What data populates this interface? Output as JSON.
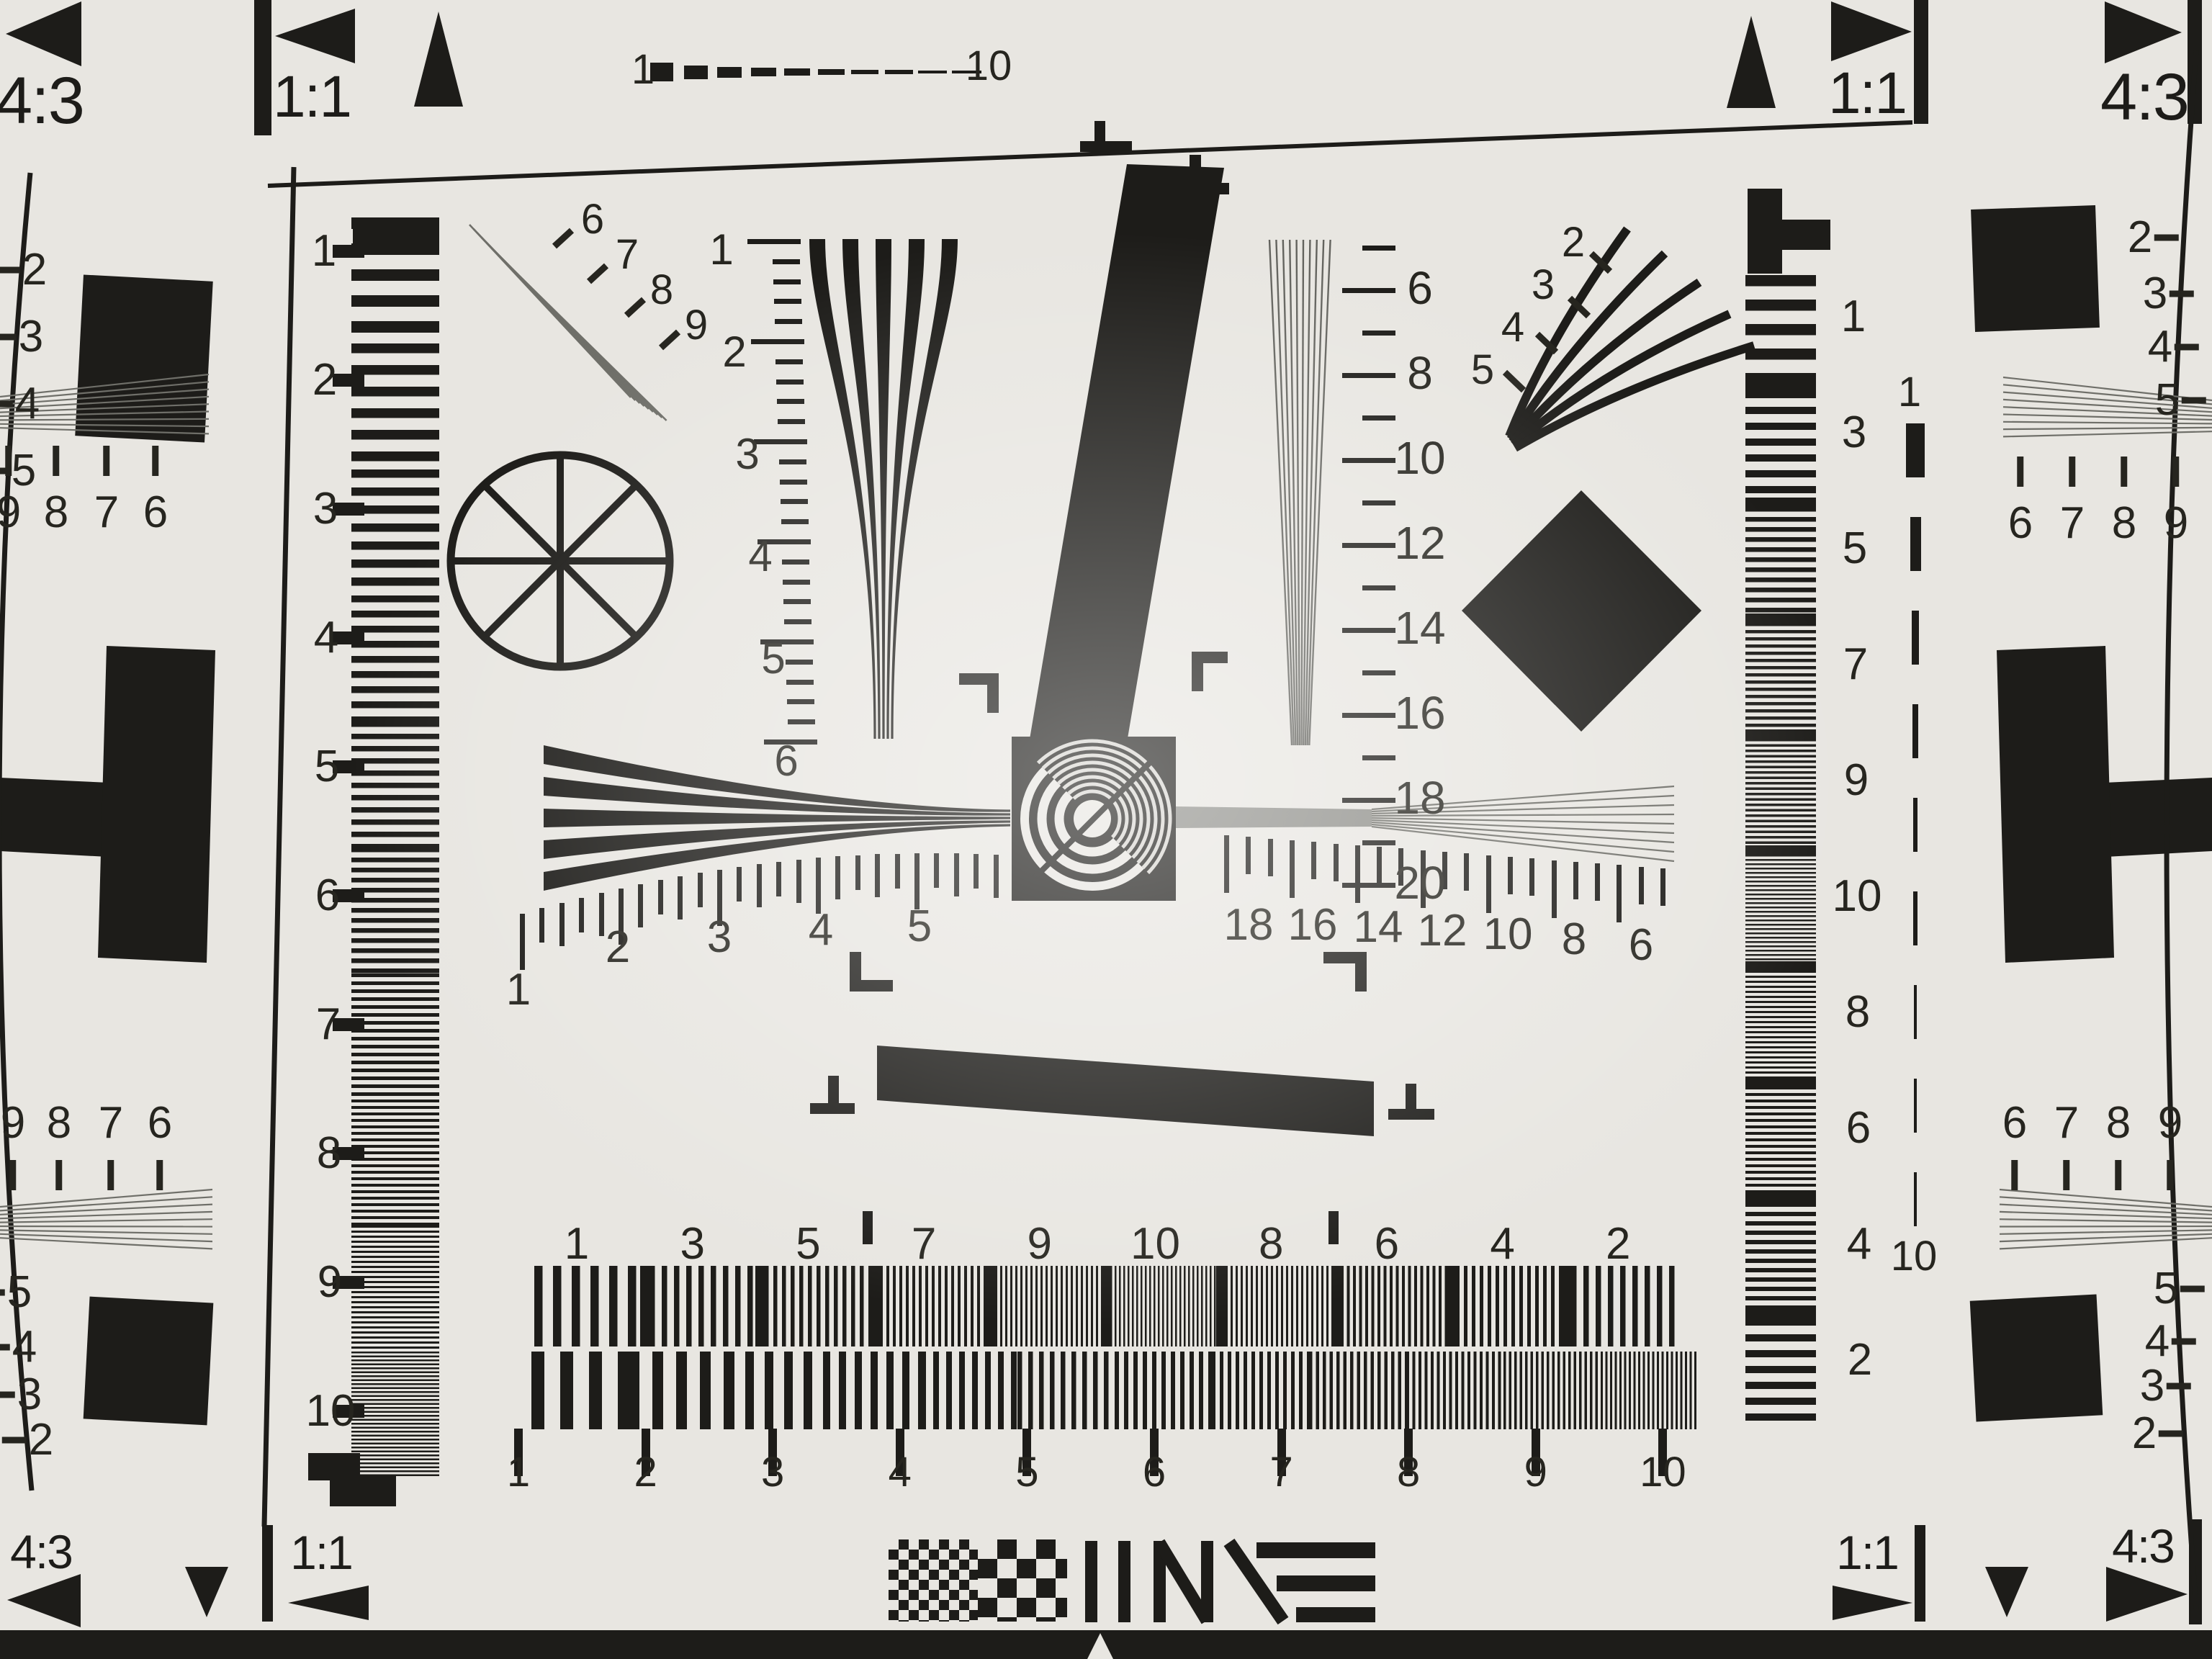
{
  "colors": {
    "background": "#e8e6e1",
    "ink": "#1d1c19",
    "gray_lines": "#6f6f69"
  },
  "corners": {
    "top_left_ratio": "4:3",
    "top_left_square": "1:1",
    "top_right_square": "1:1",
    "top_right_ratio": "4:3",
    "bottom_left_ratio": "4:3",
    "bottom_left_square": "1:1",
    "bottom_right_square": "1:1",
    "bottom_right_ratio": "4:3"
  },
  "scales": {
    "top_dash": [
      "1",
      "10"
    ],
    "left": [
      "1",
      "2",
      "3",
      "4",
      "5",
      "6",
      "7",
      "8",
      "9",
      "10"
    ],
    "hyperbola": [
      "1",
      "2",
      "3",
      "4",
      "5",
      "6"
    ],
    "vertical_fan": [
      "6",
      "8",
      "10",
      "12",
      "14",
      "16",
      "18",
      "20"
    ],
    "burst_top_left": [
      "6",
      "7",
      "8",
      "9"
    ],
    "fan_top_right": [
      "2",
      "3",
      "4",
      "5"
    ],
    "ruler_left": [
      "1",
      "2",
      "3",
      "4",
      "5"
    ],
    "ruler_right": [
      "18",
      "16",
      "14",
      "12",
      "10",
      "8",
      "6"
    ],
    "right_column": [
      "1",
      "3",
      "5",
      "7",
      "9",
      "10",
      "8",
      "6",
      "4",
      "2"
    ],
    "right_dash": [
      "1",
      "10"
    ],
    "sweep": [
      "1",
      "3",
      "5",
      "7",
      "9",
      "10",
      "8",
      "6",
      "4",
      "2"
    ],
    "bottom_ruler": [
      "1",
      "2",
      "3",
      "4",
      "5",
      "6",
      "7",
      "8",
      "9",
      "10"
    ],
    "edge_left_top": [
      "2",
      "3",
      "4",
      "5"
    ],
    "edge_right_top": [
      "2",
      "3",
      "4",
      "5"
    ],
    "edge_left_mid": [
      "9",
      "8",
      "7",
      "6"
    ],
    "edge_right_mid": [
      "6",
      "7",
      "8",
      "9"
    ],
    "edge_left_lower": [
      "9",
      "8",
      "7",
      "6"
    ],
    "edge_right_lower": [
      "6",
      "7",
      "8",
      "9"
    ],
    "edge_left_bottom": [
      "5",
      "4",
      "3",
      "2"
    ],
    "edge_right_bottom": [
      "5",
      "4",
      "3",
      "2"
    ]
  }
}
